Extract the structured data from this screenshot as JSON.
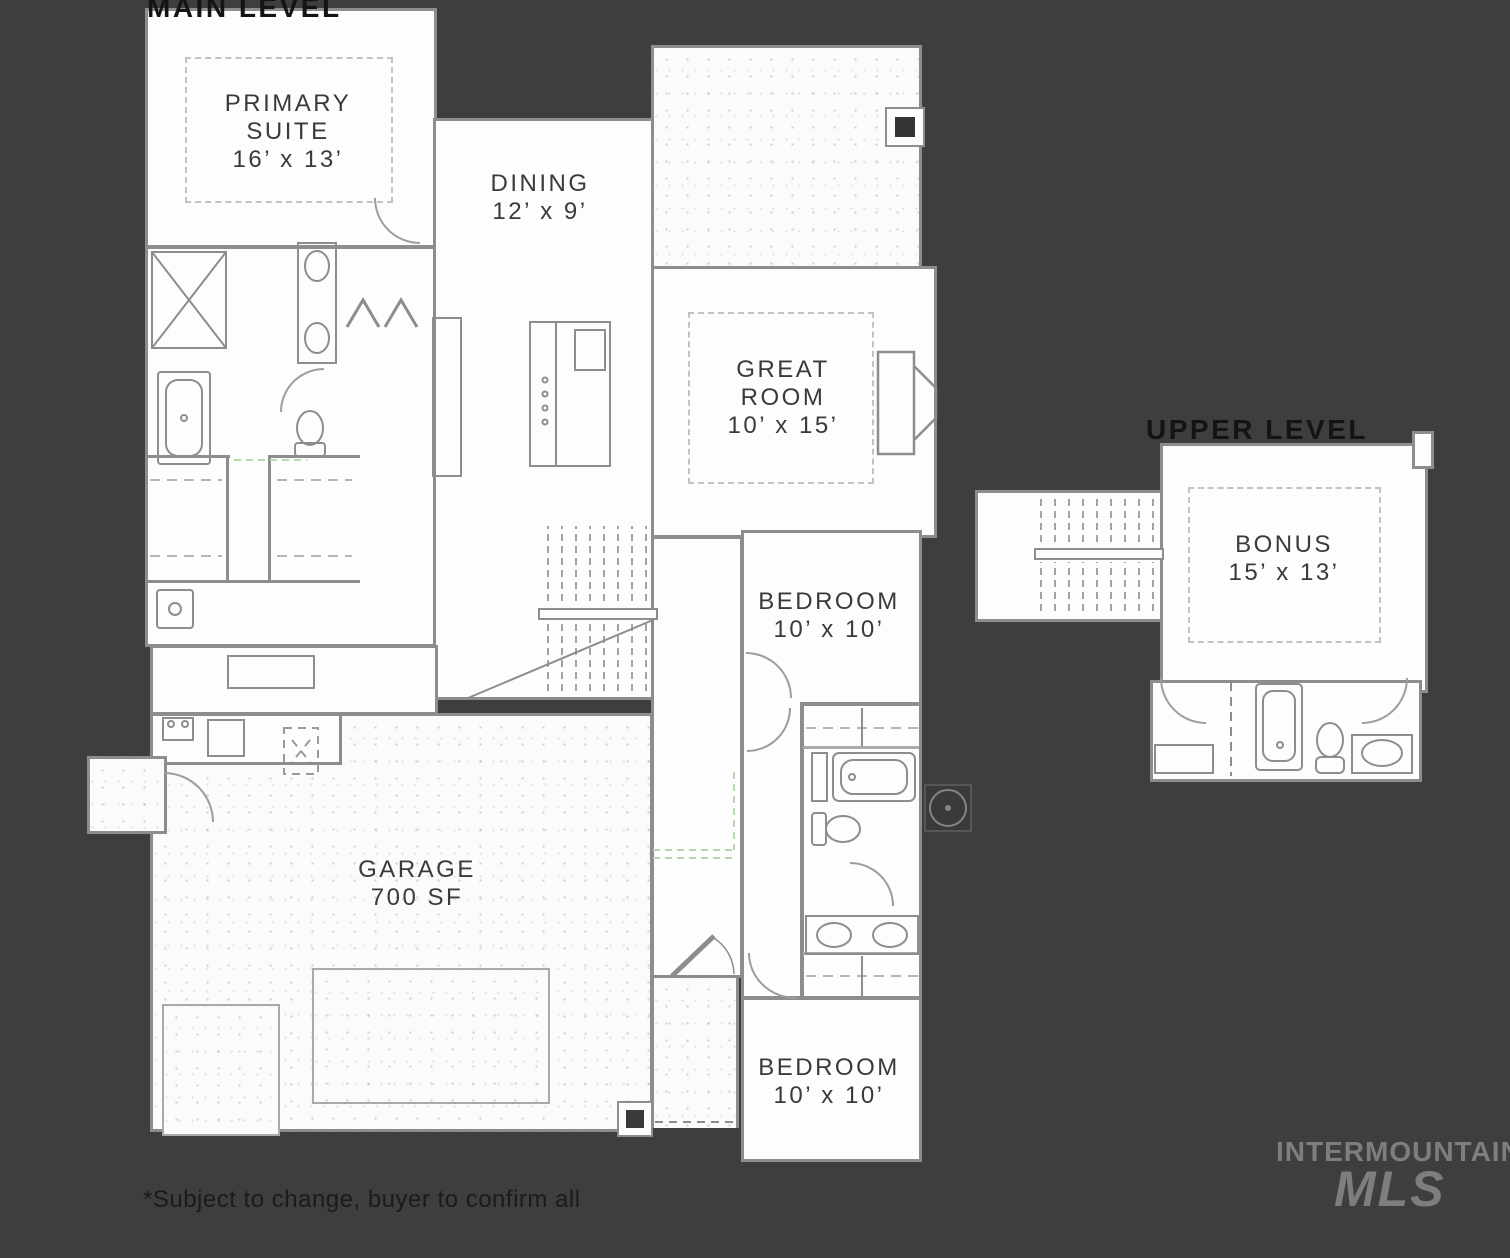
{
  "colors": {
    "background": "#3e3e3e",
    "floor": "#fdfdfd",
    "walls": "#8d8d8d",
    "label_text": "#3a3a3a",
    "title_text": "#141414",
    "watermark": "#7e7e7e",
    "guide_green": "#b7d7ae"
  },
  "main_level": {
    "title": "MAIN LEVEL",
    "rooms": {
      "primary_suite": {
        "line1": "PRIMARY",
        "line2": "SUITE",
        "dims": "16’ x 13’"
      },
      "dining": {
        "line1": "DINING",
        "dims": "12’ x 9’"
      },
      "great_room": {
        "line1": "GREAT",
        "line2": "ROOM",
        "dims": "10’ x 15’"
      },
      "bedroom_upper": {
        "line1": "BEDROOM",
        "dims": "10’ x 10’"
      },
      "bedroom_lower": {
        "line1": "BEDROOM",
        "dims": "10’ x 10’"
      },
      "garage": {
        "line1": "GARAGE",
        "dims": "700 SF"
      }
    }
  },
  "upper_level": {
    "title": "UPPER LEVEL",
    "rooms": {
      "bonus": {
        "line1": "BONUS",
        "dims": "15’ x 13’"
      }
    }
  },
  "footer": {
    "note": "*Subject to change, buyer to confirm all"
  },
  "watermark": {
    "line1": "INTERMOUNTAIN",
    "line2": "MLS"
  }
}
